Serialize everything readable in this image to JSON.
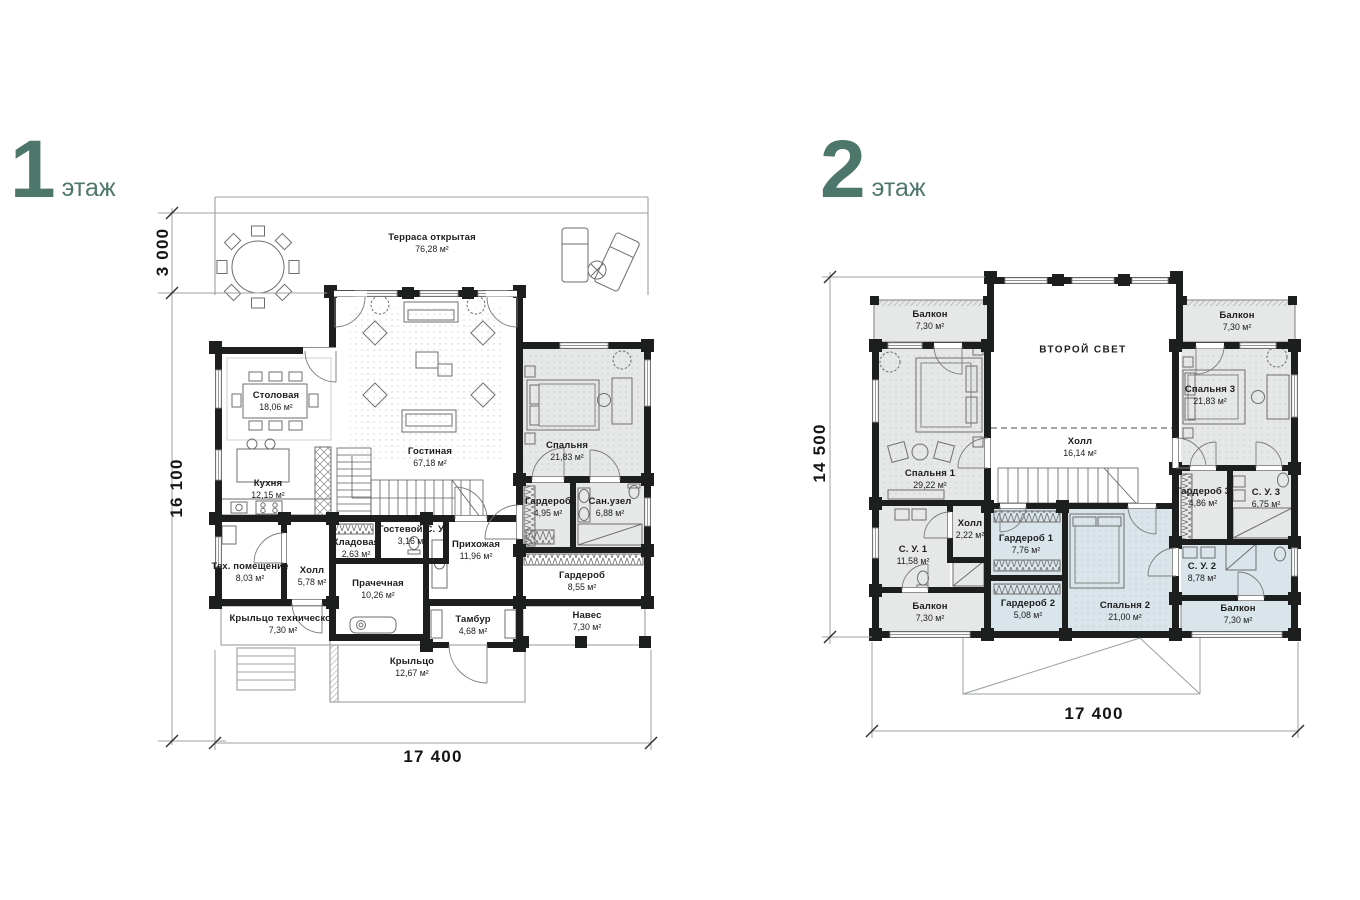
{
  "colors": {
    "accent": "#4e776c",
    "room_gray": "#e5e8e6",
    "room_blue": "#d9e5ea",
    "wall": "#1d1f1e"
  },
  "floor1": {
    "title_number": "1",
    "title_word": "этаж",
    "dims": {
      "terrace": "3 000",
      "body": "16 100",
      "width": "17 400"
    },
    "rooms": {
      "terrace": {
        "name": "Терраса открытая",
        "area": "76,28 м²"
      },
      "dining": {
        "name": "Столовая",
        "area": "18,06 м²"
      },
      "kitchen": {
        "name": "Кухня",
        "area": "12,15 м²"
      },
      "living": {
        "name": "Гостиная",
        "area": "67,18 м²"
      },
      "bedroom": {
        "name": "Спальня",
        "area": "21,83 м²"
      },
      "wardrobe": {
        "name": "Гардероб",
        "area": "4,95 м²"
      },
      "bathroom": {
        "name": "Сан.узел",
        "area": "6,88 м²"
      },
      "tech": {
        "name": "Тех. помещение",
        "area": "8,03 м²"
      },
      "hall": {
        "name": "Холл",
        "area": "5,78 м²"
      },
      "pantry": {
        "name": "Кладовая",
        "area": "2,63 м²"
      },
      "guest_wc": {
        "name": "Гостевой С. У.",
        "area": "3,16 м²"
      },
      "laundry": {
        "name": "Прачечная",
        "area": "10,26 м²"
      },
      "entry": {
        "name": "Прихожая",
        "area": "11,96 м²"
      },
      "vestibule": {
        "name": "Тамбур",
        "area": "4,68 м²"
      },
      "wardrobe2": {
        "name": "Гардероб",
        "area": "8,55 м²"
      },
      "canopy": {
        "name": "Навес",
        "area": "7,30 м²"
      },
      "tech_porch": {
        "name": "Крыльцо техническое",
        "area": "7,30 м²"
      },
      "porch": {
        "name": "Крыльцо",
        "area": "12,67 м²"
      }
    }
  },
  "floor2": {
    "title_number": "2",
    "title_word": "этаж",
    "dims": {
      "height": "14 500",
      "width": "17 400"
    },
    "rooms": {
      "balcony_tl": {
        "name": "Балкон",
        "area": "7,30 м²"
      },
      "balcony_tr": {
        "name": "Балкон",
        "area": "7,30 м²"
      },
      "balcony_bl": {
        "name": "Балкон",
        "area": "7,30 м²"
      },
      "balcony_br": {
        "name": "Балкон",
        "area": "7,30 м²"
      },
      "bedroom1": {
        "name": "Спальня 1",
        "area": "29,22 м²"
      },
      "second_light": {
        "name": "ВТОРОЙ СВЕТ",
        "area": ""
      },
      "hall": {
        "name": "Холл",
        "area": "16,14 м²"
      },
      "bedroom3": {
        "name": "Спальня 3",
        "area": "21,83 м²"
      },
      "wardrobe3": {
        "name": "Гардероб 3",
        "area": "4,86 м²"
      },
      "wc3": {
        "name": "С. У. 3",
        "area": "6,75 м²"
      },
      "wc1": {
        "name": "С. У. 1",
        "area": "11,58 м²"
      },
      "hall_small": {
        "name": "Холл",
        "area": "2,22 м²"
      },
      "wardrobe1": {
        "name": "Гардероб 1",
        "area": "7,76 м²"
      },
      "wardrobe2": {
        "name": "Гардероб 2",
        "area": "5,08 м²"
      },
      "bedroom2": {
        "name": "Спальня 2",
        "area": "21,00 м²"
      },
      "wc2": {
        "name": "С. У. 2",
        "area": "8,78 м²"
      }
    }
  }
}
